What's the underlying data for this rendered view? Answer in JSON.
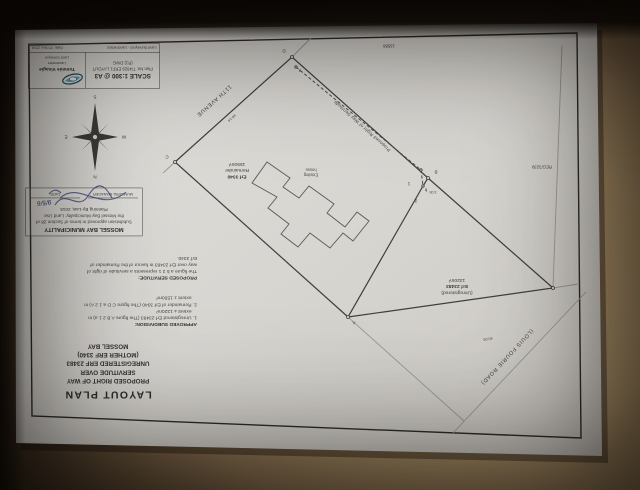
{
  "title_block": {
    "title": "LAYOUT PLAN",
    "lines": [
      "PROPOSED RIGHT OF WAY",
      "SERVITUDE OVER",
      "UNREGISTERED ERF 23483",
      "(MOTHER ERF 3340)",
      "MOSSEL BAY"
    ]
  },
  "subdivision_note": {
    "heading": "APPROVED SUBDIVISION:",
    "lines": [
      "1. Unregistered Erf 23483 (The figure A B 2 1 a) in",
      "    extent ± 1320m²",
      "2. Remainder of Erf 3340 (The figure C D a 1 2 A) in",
      "    extent ± 1550m²"
    ]
  },
  "servitude_note": {
    "heading": "PROPOSED SERVITUDE:",
    "lines": [
      "The figure a b 2 1 represents a servitude of right of",
      "way over Erf 23483 in favour of the Remainder of",
      "Erf 3340."
    ]
  },
  "approval_stamp": {
    "heading": "MOSSEL BAY MUNICIPALITY",
    "body_lines": [
      "Subdivision approved in terms of Section 28 of",
      "the Mossel Bay Municipality: Land Use",
      "Planning By-Law, 2015"
    ],
    "signature_label": "MUNICIPAL MANAGER",
    "date_label": "DATE",
    "handwritten_date": "9/5/6"
  },
  "info_box": {
    "scale": "SCALE 1:300 @ A3",
    "plan_no": "Plan No: T/4829 ERF1 LAYOUT",
    "dwg": "(R1) DWG",
    "date": "Date: 05 Nov 2024"
  },
  "surveyor": {
    "name": "Tommie Visagie",
    "title_1": "Landmeter",
    "title_2": "Land Surveyor",
    "tagline": "Land Surveyors · Landmeters"
  },
  "parcels": {
    "remainder": {
      "line1": "Erf 3340",
      "line2": "Remainder",
      "area": "1550m²"
    },
    "unregistered": {
      "line1": "(Unregistered)",
      "line2": "Erf 23483",
      "area": "1320m²"
    }
  },
  "labels": {
    "house_line1": "Existing",
    "house_line2": "house",
    "avenue": "11TH AVENUE",
    "road": "(LOUIS FOURIE ROAD)",
    "servitude_line": "Proposed Right of Way Servitude",
    "neighbour_top": "16588",
    "neighbour_right": "REG/3239",
    "dim_cd": "44.14",
    "dim_ar": "40.09",
    "dim_jog": "3.00"
  },
  "points": {
    "A": "A",
    "B": "B",
    "C": "C",
    "D": "D",
    "a": "a",
    "b": "b",
    "p1": "1",
    "p2": "2"
  },
  "compass": {
    "n": "N",
    "s": "S",
    "e": "E",
    "w": "W"
  },
  "colors": {
    "paper": "#d8d6d1",
    "table": "#b49b73",
    "ink": "#3a3a3a",
    "pen": "#2b3668"
  }
}
